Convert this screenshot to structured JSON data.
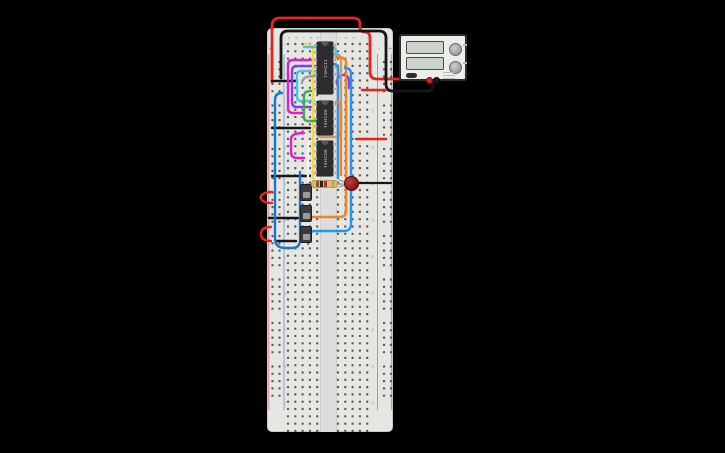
{
  "app": {
    "background": "#000000",
    "title": "circuit canvas"
  },
  "breadboard": {
    "x": 267,
    "y": 28,
    "width": 126,
    "height": 404,
    "body_color": "#e6e6e3",
    "hole_color": "#4a4a4a",
    "channel_color": "#dddddb",
    "rows": 54,
    "row_start": 16,
    "row_spacing": 7.3,
    "column_letters": [
      "a",
      "b",
      "c",
      "d",
      "e",
      "f",
      "g",
      "h",
      "i",
      "j"
    ],
    "column_x": [
      21,
      28.3,
      35.6,
      42.9,
      50.2,
      71,
      78.3,
      85.6,
      92.9,
      100.2
    ],
    "row_numbers": [
      1,
      5,
      10,
      15,
      20,
      25,
      30,
      35,
      40,
      45,
      50
    ],
    "rail_plus": "+",
    "rail_minus": "-",
    "rail_plus_color": "#c0524b",
    "rail_minus_color": "#5b79c9"
  },
  "chips": [
    {
      "label": "74HC11",
      "x": 317,
      "y": 42,
      "w": 16,
      "h": 52
    },
    {
      "label": "74HC86",
      "x": 317,
      "y": 101,
      "w": 16,
      "h": 34
    },
    {
      "label": "74HC08",
      "x": 317,
      "y": 141,
      "w": 16,
      "h": 35
    }
  ],
  "switches": [
    {
      "x": 300,
      "y": 184
    },
    {
      "x": 300,
      "y": 205
    },
    {
      "x": 300,
      "y": 226
    }
  ],
  "resistor": {
    "x": 311,
    "y": 180,
    "w": 27,
    "h": 8,
    "body_color": "#d9b977",
    "band_colors": [
      "#8a5a2b",
      "#222222",
      "#b03030",
      "#c9a227"
    ],
    "band_names": [
      "brown",
      "black",
      "red",
      "gold"
    ],
    "band_left": [
      4,
      8.2,
      12.4,
      19.5
    ]
  },
  "led": {
    "x": 343.5,
    "y": 175.5,
    "size": 15,
    "color_center": "#b23b3b",
    "color_body": "#8f1d1d",
    "color_rim": "#6f1111"
  },
  "power_supply": {
    "x": 399,
    "y": 34,
    "w": 68,
    "h": 47,
    "screens": [
      {
        "top": 5
      },
      {
        "top": 21
      }
    ],
    "knobs": [
      {
        "top": 7
      },
      {
        "top": 25
      }
    ],
    "positive_terminal": {
      "left": 24.5,
      "top": 41,
      "color": "#d42420",
      "ring": "#8a0f0f"
    },
    "negative_terminal": {
      "left": 31.5,
      "top": 41,
      "color": "#1a1a1a",
      "ring": "#000000"
    }
  },
  "wires": [
    {
      "name": "wire-red-supply",
      "color": "#e8251d",
      "width": 2.8,
      "d": "M272,82 V26 Q272,18 280,18 H353 Q360,18 360,24 V27 Q360,32 365,32 Q370,32 370,38 V72 Q370,79 377,79 H424"
    },
    {
      "name": "wire-black-supply",
      "color": "#161616",
      "width": 2.8,
      "d": "M281,78 V38 Q281,31 288,31 H379 Q386,31 386,38 V84 Q386,91 393,91 H427 Q433,91 433,85 V80"
    },
    {
      "name": "black-jumper-1",
      "color": "#161616",
      "width": 2.4,
      "d": "M272,81 H297"
    },
    {
      "name": "black-jumper-2",
      "color": "#161616",
      "width": 2.4,
      "d": "M272,128 H310"
    },
    {
      "name": "black-jumper-3",
      "color": "#161616",
      "width": 2.4,
      "d": "M272,176 H310"
    },
    {
      "name": "black-jumper-4",
      "color": "#161616",
      "width": 2.4,
      "d": "M269,218 H298"
    },
    {
      "name": "black-jumper-5",
      "color": "#161616",
      "width": 2.4,
      "d": "M277,241 H296"
    },
    {
      "name": "red-hook-1",
      "color": "#e8251d",
      "width": 2.4,
      "d": "M272,192 C257,192 257,203 272,203"
    },
    {
      "name": "red-hook-2",
      "color": "#e8251d",
      "width": 2.4,
      "d": "M271,227 Q261,227 261,234 Q261,241 271,241"
    },
    {
      "name": "red-jumper-right-1",
      "color": "#e8251d",
      "width": 2.4,
      "d": "M362,90 H386"
    },
    {
      "name": "red-jumper-right-2",
      "color": "#e8251d",
      "width": 2.4,
      "d": "M356,139 H386"
    },
    {
      "name": "wire-magenta-1",
      "color": "#e31ec8",
      "width": 2.4,
      "d": "M314,60 H293 Q288,60 288,65 V108 Q288,113 293,113 H303"
    },
    {
      "name": "wire-purple-left",
      "color": "#7e3ff2",
      "width": 2.4,
      "d": "M315,66 H297 Q292,66 292,71 V102 Q292,107 297,107 H311"
    },
    {
      "name": "wire-purple-right",
      "color": "#7e3ff2",
      "width": 2.4,
      "d": "M337,84 Q337,75 343,75 Q349,75 349,82 V88"
    },
    {
      "name": "wire-cyan-loop",
      "color": "#45c5e8",
      "width": 2.4,
      "d": "M315,71 H301 Q297,71 297,75 V97 Q297,101 301,101 H314"
    },
    {
      "name": "wire-magenta-2",
      "color": "#e31ec8",
      "width": 2.4,
      "d": "M304,133 Q291,133 291,139 V152 Q291,158 297,158 H304"
    },
    {
      "name": "wire-yellow",
      "color": "#fdd835",
      "width": 2.4,
      "d": "M305,44 Q313,44 313,50 V188"
    },
    {
      "name": "wire-white",
      "color": "#f2f2f2",
      "width": 2.4,
      "d": "M308,143 V180"
    },
    {
      "name": "wire-green",
      "color": "#3fae49",
      "width": 2.4,
      "d": "M311,91 Q304,91 304,96 V117 Q304,121 308,121 H324"
    },
    {
      "name": "wire-gray",
      "color": "#9e9e9e",
      "width": 2.4,
      "d": "M315,76 Q302,76 302,83"
    },
    {
      "name": "wire-tan",
      "color": "#c69c6d",
      "width": 2.4,
      "d": "M334,54 Q341,54 341,60 V130 Q341,137 334,137 H322 Q317,137 317,132 V127"
    },
    {
      "name": "wire-blue-mid",
      "color": "#2196f3",
      "width": 2.4,
      "d": "M334,64 Q338,64 338,70 V178"
    },
    {
      "name": "wire-cyan-cross",
      "color": "#45c5e8",
      "width": 2.4,
      "d": "M304,47 H331 Q336,47 336,52 V57"
    },
    {
      "name": "wire-orange-1",
      "color": "#f58220",
      "width": 2.4,
      "d": "M337,57 Q346,57 346,63 V211 Q346,217 340,217 H312"
    },
    {
      "name": "wire-orange-2",
      "color": "#f58220",
      "width": 2.4,
      "d": "M336,102 Q341,102 341,108 V175"
    },
    {
      "name": "wire-blue-right",
      "color": "#2196f3",
      "width": 2.4,
      "d": "M345,68 Q351,68 351,74 V224 Q351,231 344,231 H315 Q308,231 308,238 V244"
    },
    {
      "name": "wire-blue-left-u",
      "color": "#1976d2",
      "width": 2.4,
      "d": "M282,93 Q275,93 275,100 V238 Q275,248 285,248 H292 Q300,248 300,240 V172"
    },
    {
      "name": "led-lead",
      "color": "#161616",
      "width": 2.2,
      "d": "M356,183 H391"
    },
    {
      "name": "led-leg-top",
      "color": "#9e9e9e",
      "width": 1.4,
      "d": "M339,180 L345,182"
    },
    {
      "name": "led-leg-bottom",
      "color": "#9e9e9e",
      "width": 1.4,
      "d": "M339,187 L345,185"
    },
    {
      "name": "resistor-lead-left",
      "color": "#9e9e9e",
      "width": 1.4,
      "d": "M306,184 H312"
    },
    {
      "name": "resistor-lead-right",
      "color": "#9e9e9e",
      "width": 1.4,
      "d": "M337,184 H343"
    }
  ]
}
